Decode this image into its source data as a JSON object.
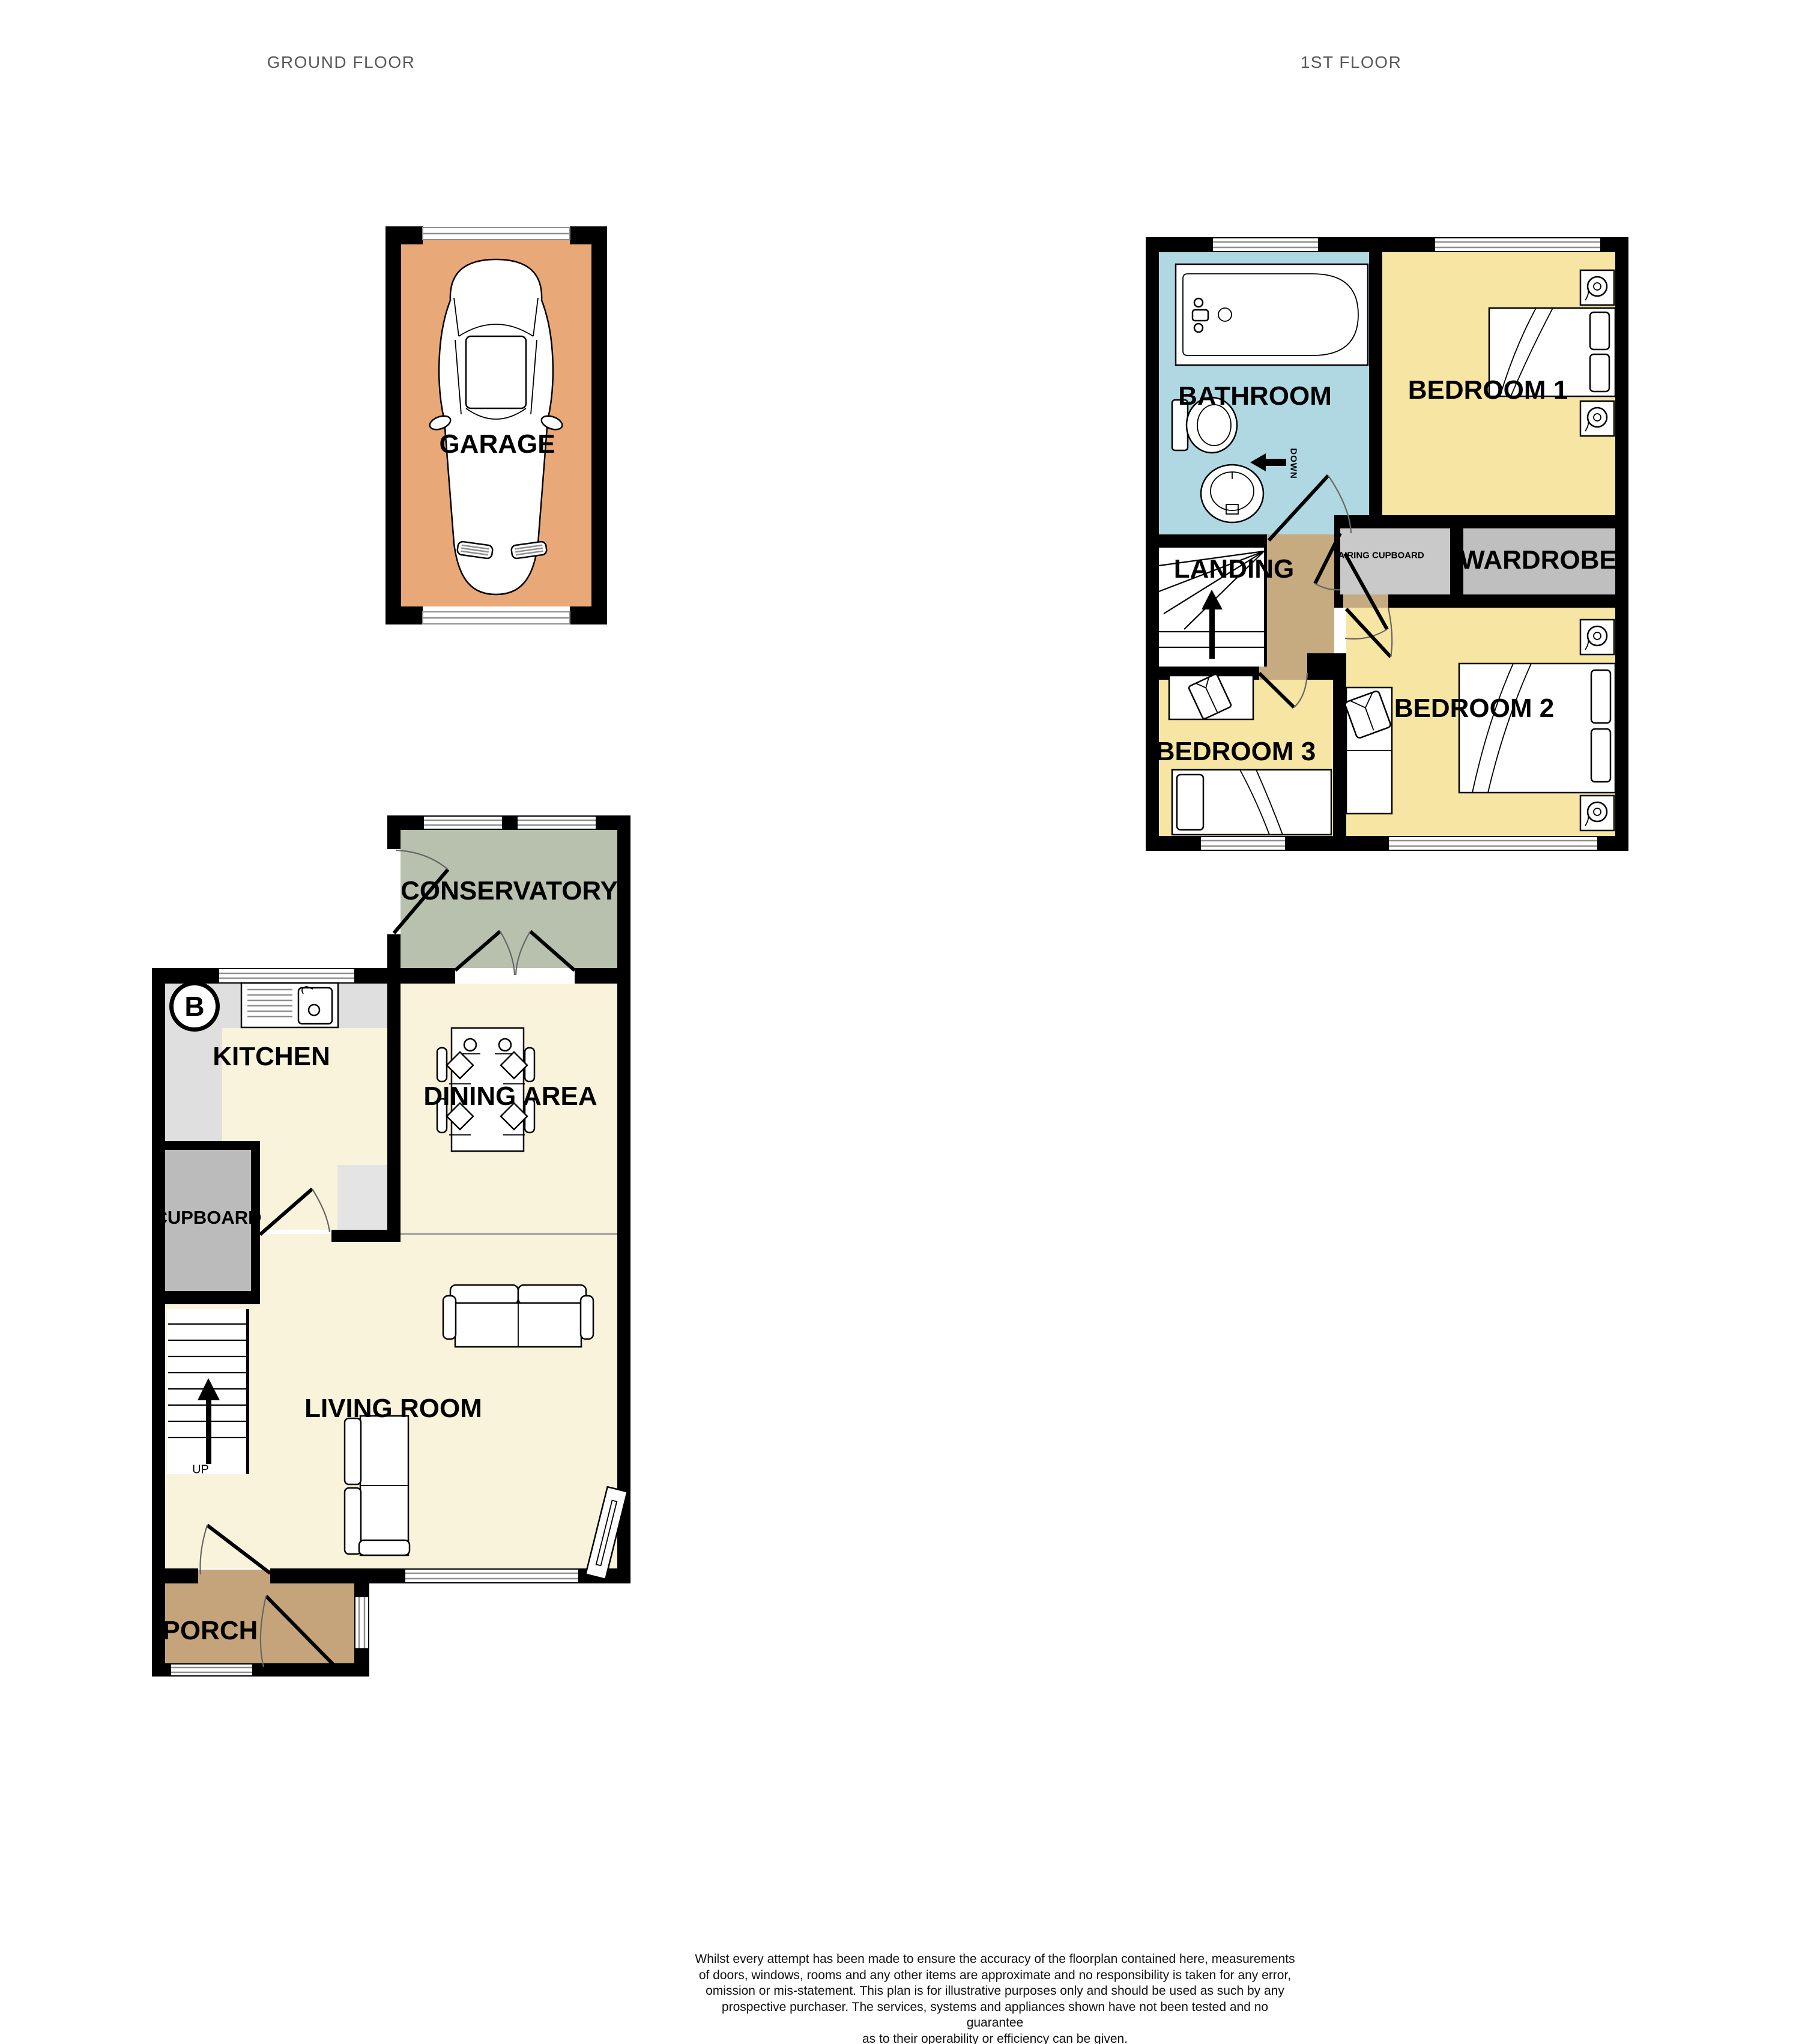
{
  "page": {
    "ground_floor_title": "GROUND FLOOR",
    "first_floor_title": "1ST FLOOR"
  },
  "ground_floor": {
    "rooms": {
      "garage": {
        "label": "GARAGE",
        "color": "#E8A878"
      },
      "conservatory": {
        "label": "CONSERVATORY",
        "color": "#B8C0AE"
      },
      "kitchen": {
        "label": "KITCHEN",
        "color": "#DFDFDF"
      },
      "kitchen_floor": {
        "label": "",
        "color": "#FAF3DC"
      },
      "dining": {
        "label": "DINING AREA",
        "color": "#FAF3DC"
      },
      "cupboard": {
        "label": "CUPBOARD",
        "color": "#BBBBBB"
      },
      "living": {
        "label": "LIVING ROOM",
        "color": "#FAF3DC"
      },
      "porch": {
        "label": "PORCH",
        "color": "#C5A47C"
      }
    },
    "stairs_up_label": "UP",
    "compass_label": "B"
  },
  "first_floor": {
    "rooms": {
      "bathroom": {
        "label": "BATHROOM",
        "color": "#AFD8E2"
      },
      "bedroom1": {
        "label": "BEDROOM 1",
        "color": "#F6E5A3"
      },
      "landing": {
        "label": "LANDING",
        "color": "#C6AA80"
      },
      "airing_cupboard": {
        "label": "AIRING CUPBOARD",
        "color": "#C9C9C9"
      },
      "wardrobe": {
        "label": "WARDROBE",
        "color": "#BFBFBF"
      },
      "bedroom2": {
        "label": "BEDROOM 2",
        "color": "#F6E5A3"
      },
      "bedroom3": {
        "label": "BEDROOM 3",
        "color": "#F6E5A3"
      }
    },
    "stairs_down_label": "DOWN"
  },
  "footer": {
    "disclaimer_lines": [
      "Whilst every attempt has been made to ensure the accuracy of the floorplan contained here, measurements",
      "of doors, windows, rooms and any other items are approximate and no responsibility is taken for any error,",
      "omission or mis-statement. This plan is for illustrative purposes only and should be used as such by any",
      "prospective purchaser. The services, systems and appliances shown have not been tested and no guarantee",
      "as to their operability or efficiency can be given."
    ],
    "credit": "Made with Metropix ©2025"
  }
}
